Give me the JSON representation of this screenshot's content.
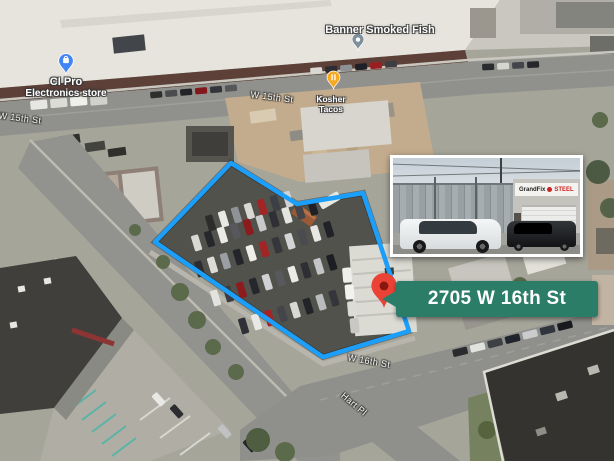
{
  "map": {
    "poi_ci_pro": {
      "line1": "CI Pro",
      "line2": "Electronics store"
    },
    "poi_banner": {
      "name": "Banner Smoked Fish"
    },
    "poi_kosher": {
      "line1": "Kosher",
      "line2": "Tacos"
    },
    "street_label_top": "W 15th St",
    "street_label_left": "W 15th St",
    "street_label_w16": "W 16th St",
    "street_label_hart": "Hart Pl",
    "address_callout": "2705 W 16th St",
    "colors": {
      "parcel_outline": "#1C9FFA",
      "callout_green": "#2B7D68",
      "pin_red": "#EA4335",
      "pin_blue": "#4285F4",
      "pin_orange": "#F7A922",
      "pin_gray": "#7D909B"
    }
  },
  "inset": {
    "sign_black": "GrandFix",
    "sign_red": "STEEL"
  }
}
